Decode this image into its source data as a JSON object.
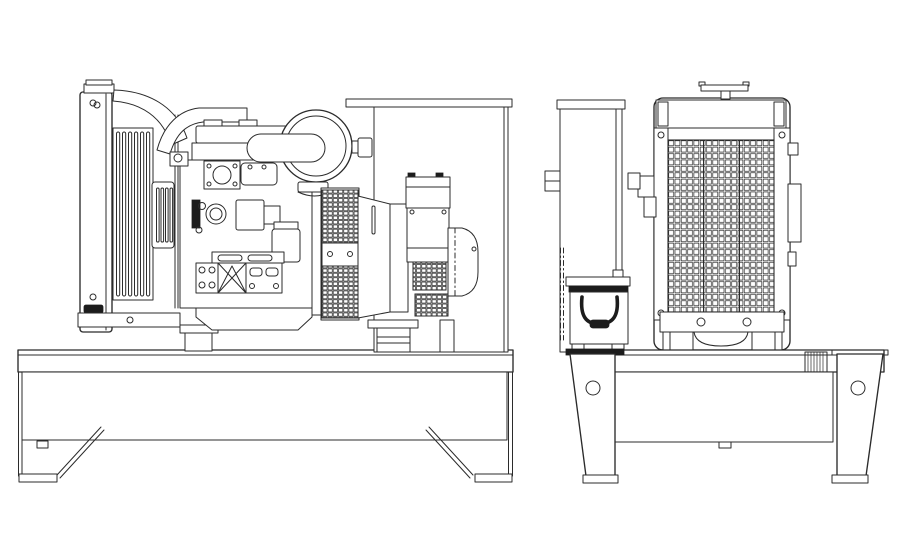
{
  "meta": {
    "description": "Two-view technical line drawing of an open-frame diesel generator set: side elevation (left) and radiator-end elevation (right)",
    "view_side_label": "side-elevation",
    "view_end_label": "end-elevation"
  },
  "colors": {
    "bg": "#ffffff",
    "line": "#2b2b2b",
    "dark": "#1c1c1c"
  },
  "components": {
    "side_view": [
      "base-skid",
      "skid-leg",
      "skid-foot",
      "diagonal-brace",
      "radiator",
      "radiator-filler-cap",
      "cooling-louvres",
      "overflow-louvre-panel",
      "radiator-support-bracket",
      "upper-radiator-hose",
      "exhaust-pipe",
      "air-cleaner",
      "rocker-cover",
      "cylinder-head",
      "exhaust-manifold-flange",
      "intake-manifold",
      "water-pump",
      "fuel-injection-pump",
      "dipstick-tube",
      "starter-motor",
      "fuel-filter",
      "engine-bed-rail",
      "front-engine-mount",
      "gusset-brace",
      "rear-engine-mount",
      "oil-pan",
      "flywheel-housing",
      "alternator-vent-grille",
      "alternator-drum",
      "terminal-box",
      "non-drive-end-cover",
      "alternator-pedestal",
      "control-panel-back-plate"
    ],
    "end_view": [
      "control-panel-pedestal",
      "battery",
      "battery-hold-down-cable",
      "radiator-top-tank",
      "radiator-filler-cap",
      "radiator-grille",
      "radiator-bottom-tank",
      "radiator-mounting-feet",
      "side-bracket",
      "base-skid",
      "skid-leg-with-lifting-hole",
      "skid-foot"
    ]
  }
}
